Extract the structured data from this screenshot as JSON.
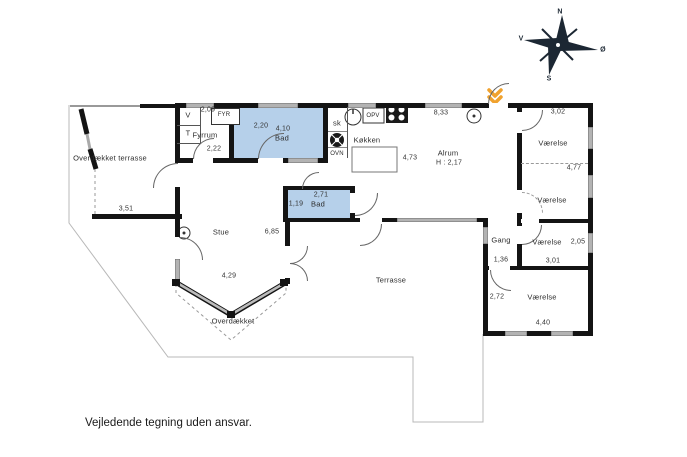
{
  "footer": {
    "disclaimer": "Vejledende tegning uden ansvar."
  },
  "compass": {
    "north": "N",
    "west": "V",
    "east": "Ø",
    "south": "S"
  },
  "colors": {
    "wall": "#141414",
    "window_gray": "#b3b3b3",
    "wet_room_blue": "#b6d0ea",
    "outline_gray": "#b8b8b8",
    "entrance_orange": "#f0a22e"
  },
  "rooms": {
    "overdaekket_terrasse": {
      "label": "Overdækket terrasse",
      "width_dim": "3,51"
    },
    "fyrrum": {
      "label": "Fyrrum",
      "top_dim": "2,09",
      "height_dim": "2,22",
      "closet_v": "V",
      "closet_t": "T",
      "furnace": "FYR"
    },
    "bad1": {
      "label": "Bad",
      "width_dim": "4,10",
      "sink_dim": "2,20"
    },
    "closets": {
      "sk": "sk",
      "ovn": "OVN"
    },
    "koekken": {
      "label": "Køkken",
      "depth_dim": "4,73",
      "dishwasher": "OPV"
    },
    "alrum": {
      "label": "Alrum",
      "ceiling_note": "H : 2,17",
      "width_dim": "8,33"
    },
    "vaerelse_ne": {
      "label": "Værelse",
      "width_dim": "3,02"
    },
    "vaerelse_e": {
      "label": "Værelse",
      "height_dim": "4,77"
    },
    "gang": {
      "label": "Gang",
      "width_dim": "1,36"
    },
    "vaerelse_se": {
      "label": "Værelse",
      "height_dim": "2,05",
      "width_dim": "3,01"
    },
    "vaerelse_s": {
      "label": "Værelse",
      "height_dim": "2,72",
      "width_dim": "4,40"
    },
    "bad2": {
      "label": "Bad",
      "width_dim": "2,71",
      "height_dim": "1,19"
    },
    "stue": {
      "label": "Stue",
      "width_dim": "6,85",
      "bay_dim": "4,29"
    },
    "overdaekket": {
      "label": "Overdækket"
    },
    "terrasse": {
      "label": "Terrasse"
    }
  },
  "icons": {
    "compass-rose": "8-point star with N/V/Ø/S",
    "entrance-arrow-icon": "orange double chevron at main door",
    "toilet-icon": "top-view toilet",
    "sink-icon": "wash basin",
    "shower-icon": "shower square with drain",
    "stove-icon": "4-burner cooktop",
    "dishwasher-icon": "OPV appliance box",
    "vent-icon": "extractor fan",
    "lamp-icon": "ceiling lamp outlet circle"
  }
}
